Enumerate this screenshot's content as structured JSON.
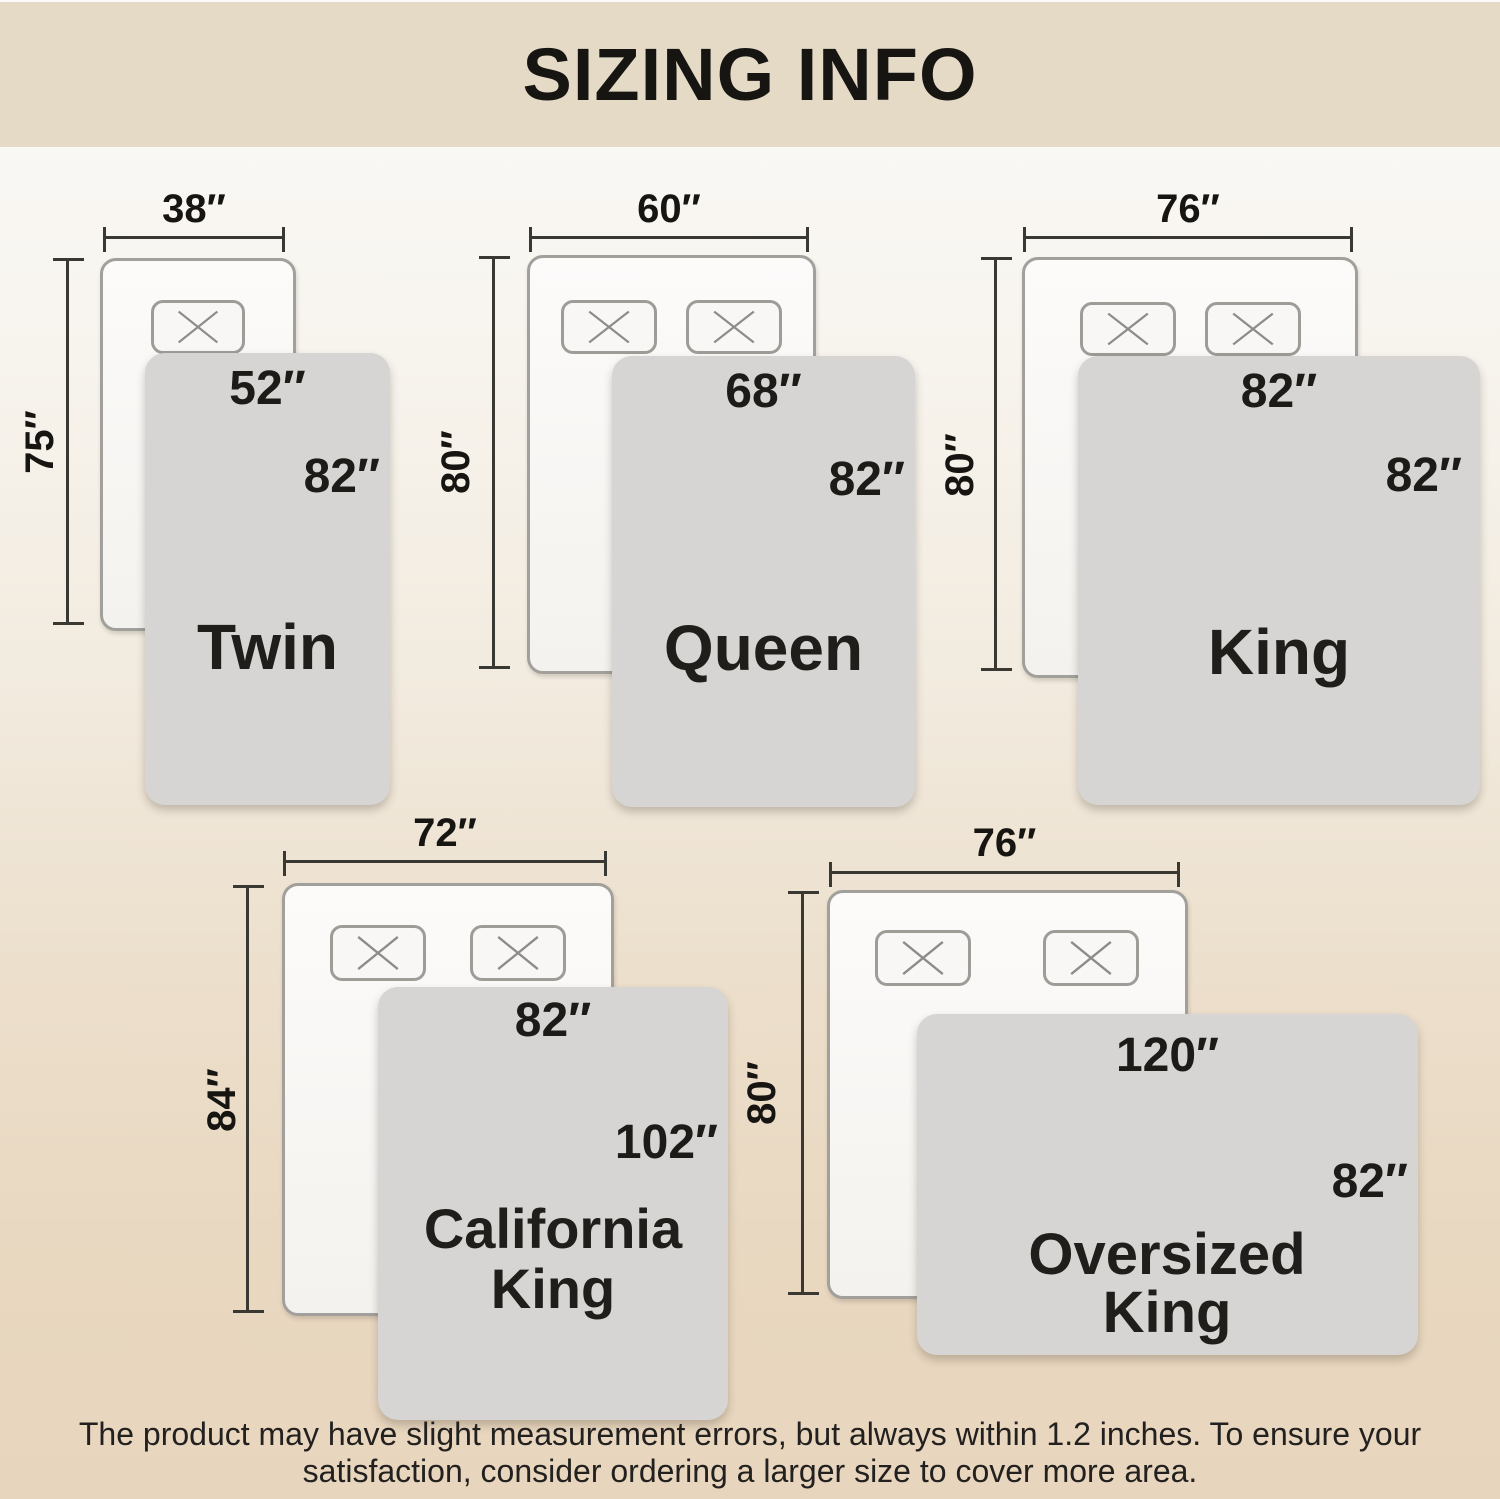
{
  "title": "SIZING INFO",
  "sizes": [
    {
      "id": "twin",
      "name": "Twin",
      "bed": {
        "width": "38″",
        "height": "75″"
      },
      "blanket": {
        "width": "52″",
        "height": "82″"
      },
      "pillows": 1
    },
    {
      "id": "queen",
      "name": "Queen",
      "bed": {
        "width": "60″",
        "height": "80″"
      },
      "blanket": {
        "width": "68″",
        "height": "82″"
      },
      "pillows": 2
    },
    {
      "id": "king",
      "name": "King",
      "bed": {
        "width": "76″",
        "height": "80″"
      },
      "blanket": {
        "width": "82″",
        "height": "82″"
      },
      "pillows": 2
    },
    {
      "id": "california-king",
      "name": "California King",
      "bed": {
        "width": "72″",
        "height": "84″"
      },
      "blanket": {
        "width": "82″",
        "height": "102″"
      },
      "pillows": 2
    },
    {
      "id": "oversized-king",
      "name": "Oversized King",
      "bed": {
        "width": "76″",
        "height": "80″"
      },
      "blanket": {
        "width": "120″",
        "height": "82″"
      },
      "pillows": 2
    }
  ],
  "footer": {
    "line1": "The product may have slight measurement errors, but always within 1.2 inches. To ensure your",
    "line2": "satisfaction, consider ordering a larger size to cover more area."
  },
  "colors": {
    "title_band": "#e4dac6",
    "background_top": "#fbfaf8",
    "background_bottom": "#e8d5bd",
    "blanket": "#d6d5d3",
    "bed_fill": "#f9f8f6",
    "bed_border": "#a2a09b",
    "dimension_line": "#3a3833",
    "text": "#1b1a18"
  }
}
